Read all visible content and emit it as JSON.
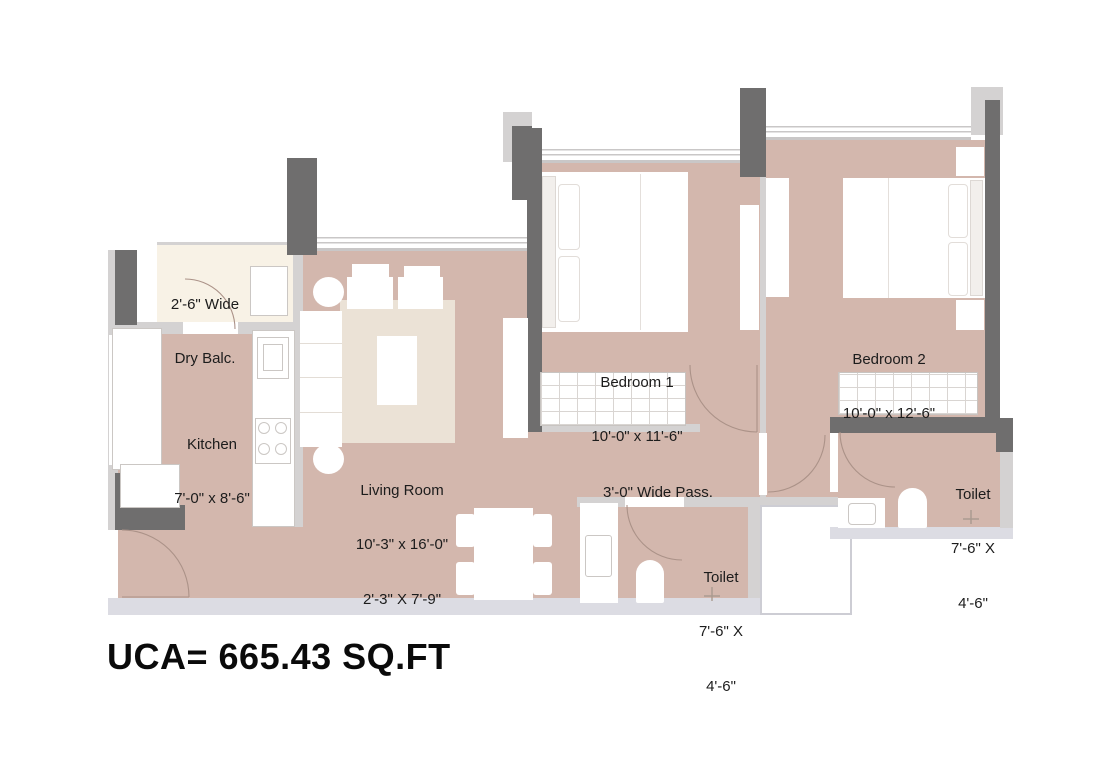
{
  "plan_title": "2 BHK floor plan",
  "rooms": {
    "dry_balcony": {
      "line1": "2'-6\" Wide",
      "line2": "Dry Balc."
    },
    "kitchen": {
      "line1": "Kitchen",
      "line2": "7'-0\" x 8'-6\""
    },
    "living": {
      "line1": "Living Room",
      "line2": "10'-3\" x 16'-0\"",
      "line3": "2'-3\" X 7'-9\""
    },
    "bedroom1": {
      "line1": "Bedroom 1",
      "line2": "10'-0\" x 11'-6\""
    },
    "bedroom2": {
      "line1": "Bedroom 2",
      "line2": "10'-0\" x 12'-6\""
    },
    "passage": {
      "line1": "3'-0\" Wide Pass."
    },
    "toilet_mid": {
      "line1": "Toilet",
      "line2": "7'-6\" X",
      "line3": "4'-6\""
    },
    "toilet_right": {
      "line1": "Toilet",
      "line2": "7'-6\" X",
      "line3": "4'-6\""
    }
  },
  "footer": {
    "uca": "UCA= 665.43 SQ.FT"
  },
  "colors": {
    "floor": "#d3b7ad",
    "balcony_floor": "#f8f2e6",
    "rug": "#ebe2d6",
    "wall_dark": "#6f6e6e",
    "wall_light": "#d4d2d2",
    "outer_band": "#dcdce3",
    "text": "#1c1c1c"
  }
}
